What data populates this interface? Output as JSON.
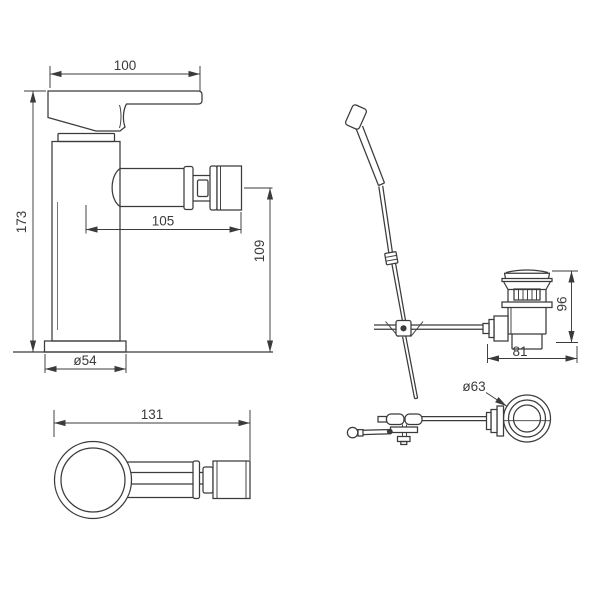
{
  "colors": {
    "background": "#ffffff",
    "line": "#3b3b3b"
  },
  "views": {
    "faucet_side": {
      "label": "bidet mixer side elevation",
      "dims": {
        "handle_width": "100",
        "overall_height": "173",
        "spout_reach": "105",
        "spout_height": "109",
        "base_diameter": "ø54"
      }
    },
    "faucet_top": {
      "label": "bidet mixer plan view",
      "dims": {
        "overall_length": "131"
      }
    },
    "waste_side": {
      "label": "pop-up waste side elevation",
      "dims": {
        "overall_height": "96",
        "overall_width": "81"
      }
    },
    "waste_top": {
      "label": "pop-up waste plan view",
      "dims": {
        "flange_diameter": "ø63"
      }
    }
  }
}
